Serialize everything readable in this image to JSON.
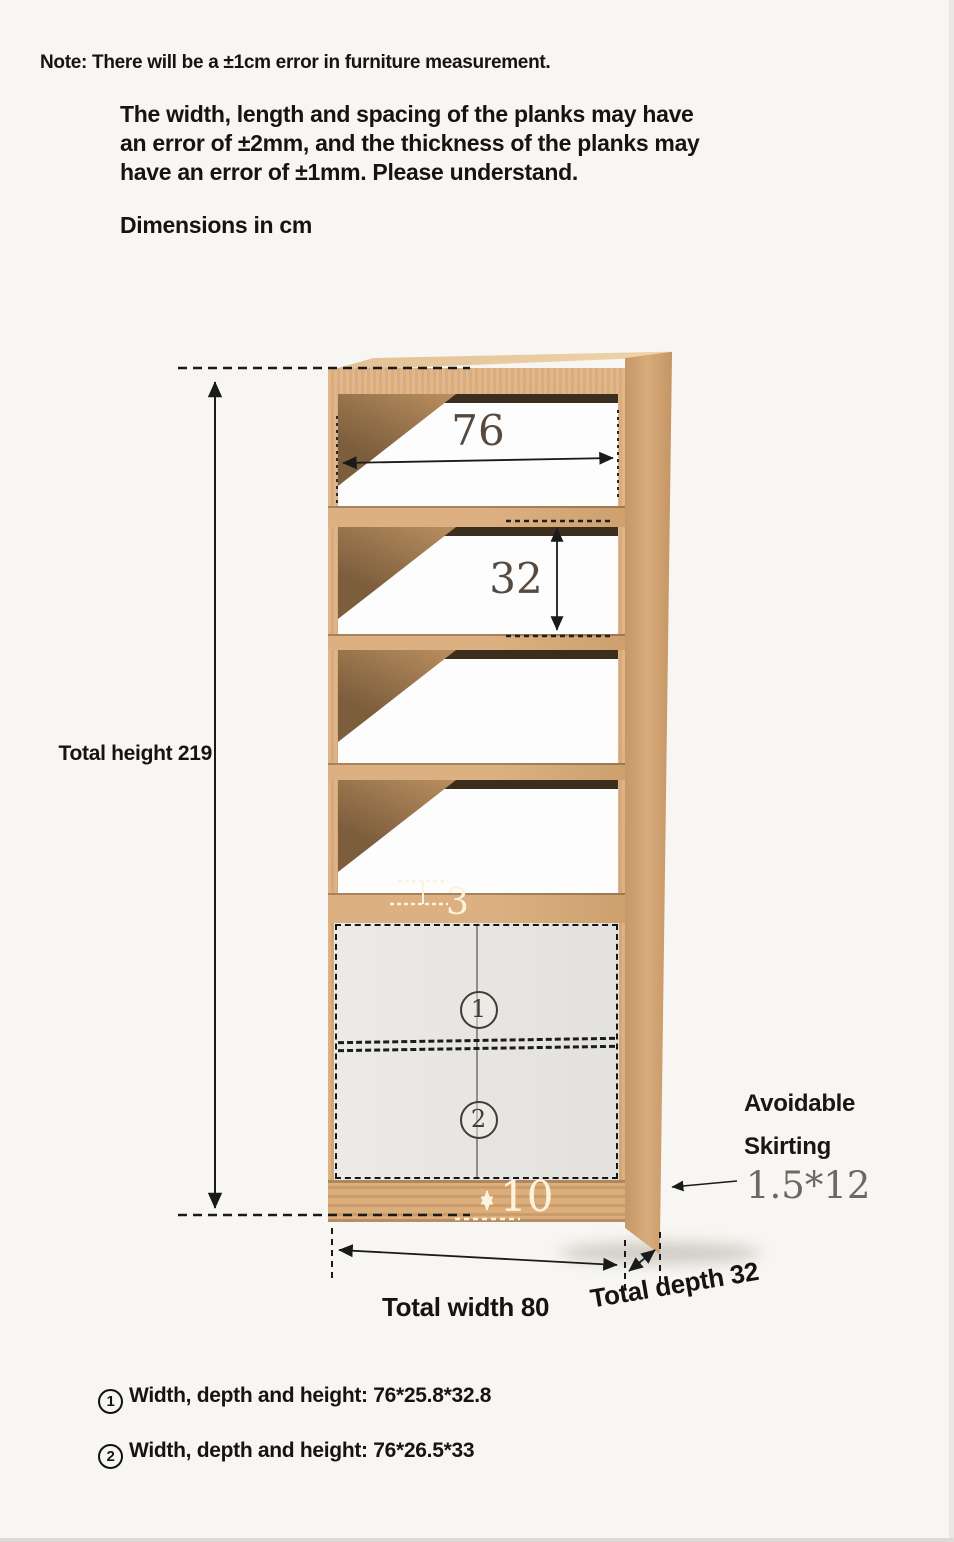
{
  "note": {
    "headline": "Note: There will be a ±1cm error in furniture measurement.",
    "paragraph_lines": [
      "The width, length and spacing of the planks may have",
      "an error of ±2mm, and the thickness of the planks may",
      "have an error of ±1mm. Please understand."
    ],
    "units_label": "Dimensions in cm"
  },
  "diagram": {
    "subject": "bookshelf with four open shelves and lower two-door cabinet",
    "dimension_labels": {
      "total_height": "Total height 219",
      "inner_width": "76",
      "opening_height": "32",
      "shelf_thickness": "3",
      "plinth_height": "10",
      "total_width": "Total width 80",
      "total_depth": "Total depth 32"
    },
    "dimension_values_cm": {
      "total_height": 219,
      "inner_width": 76,
      "opening_height": 32,
      "shelf_thickness": 3,
      "plinth_height": 10,
      "total_width": 80,
      "total_depth": 32
    },
    "skirting": {
      "line1": "Avoidable",
      "line2": "Skirting",
      "size": "1.5*12"
    },
    "door_markers": [
      {
        "num": "1"
      },
      {
        "num": "2"
      }
    ],
    "colors": {
      "wood_front": "#dcae7d",
      "wood_side": "#cfa271",
      "wood_top": "#e9cda4",
      "shelf_shadow": "#42331f",
      "back_panel": "#fdfdfd",
      "door_grey": "#e6e5e2",
      "dimension_line": "#1a1a1a",
      "dimension_number": "#57493e",
      "white_label": "#fdf3dd",
      "background": "#f7f6f2"
    }
  },
  "footnotes": [
    {
      "num": "1",
      "text": "Width, depth and height: 76*25.8*32.8"
    },
    {
      "num": "2",
      "text": "Width, depth and height: 76*26.5*33"
    }
  ]
}
